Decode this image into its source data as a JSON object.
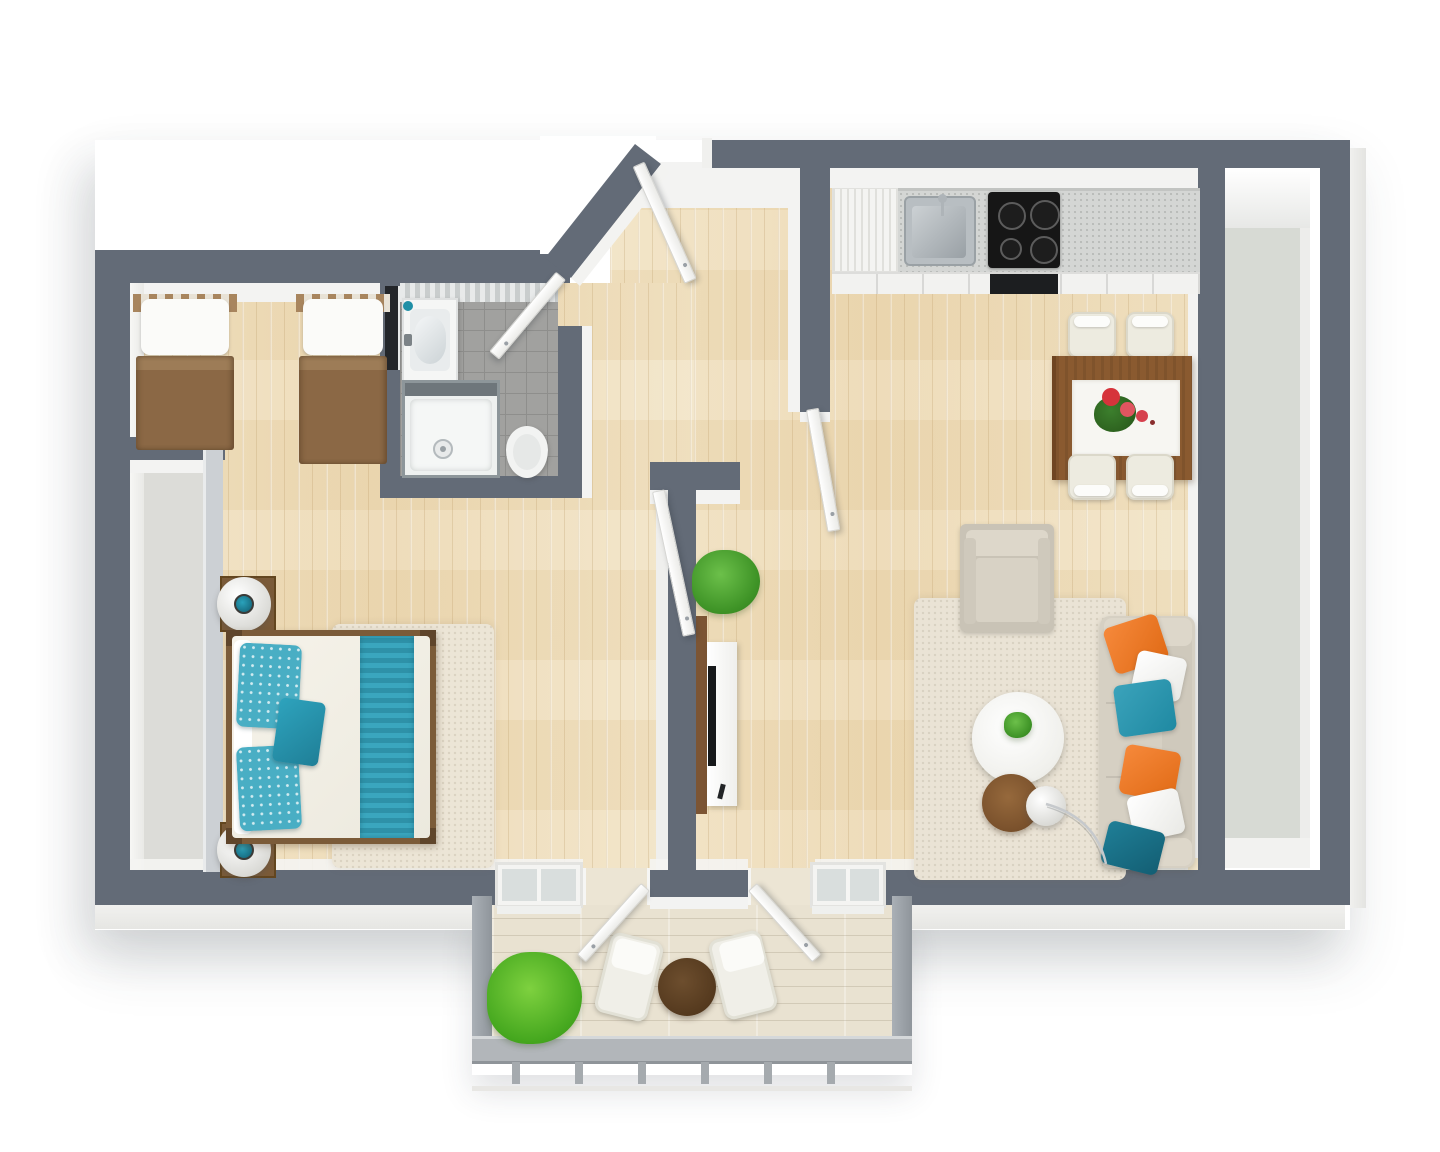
{
  "scene": {
    "title": "3D Floor Plan — One-Bedroom Apartment with Balcony",
    "view": "top-down 3D render",
    "background": "#ffffff"
  },
  "palette": {
    "wall": "#636b77",
    "wall_light": "#ccd0d4",
    "wall_face": "#f3f3f2",
    "wood_floor": "#eedcba",
    "balcony_floor": "#e9e2d1",
    "bathroom_tile": "#a1a19f",
    "closet_floor": "#dcdcd8",
    "side_balcony_floor": "#d7dad4",
    "rug": "#eae3d5",
    "sofa_beige": "#d6d0c3",
    "pillow_orange": "#ef7b28",
    "pillow_teal": "#2b93ac",
    "pillow_dark_teal": "#176d84",
    "bed_runner_teal": "#3aa6be",
    "blanket_brown": "#8b6845",
    "wood_furniture": "#8a5a30",
    "plant_green": "#46a81f",
    "railing_gray": "#b2b6ba"
  },
  "rooms": {
    "bedroom": {
      "name": "Bedroom"
    },
    "bathroom": {
      "name": "Bathroom"
    },
    "hallway": {
      "name": "Entry Hallway"
    },
    "living_room": {
      "name": "Living Room"
    },
    "kitchen": {
      "name": "Kitchen"
    },
    "dining_area": {
      "name": "Dining Area"
    },
    "closet": {
      "name": "Closet Nook"
    },
    "side_balcony": {
      "name": "Side Balcony"
    },
    "balcony": {
      "name": "Balcony"
    }
  },
  "furniture": {
    "twin_bed_1": "Twin bed with brown blanket",
    "twin_bed_2": "Twin bed with brown blanket",
    "double_bed": "Double bed with teal pillows and runner",
    "nightstand_1": "Nightstand with round lamp",
    "nightstand_2": "Nightstand with round lamp",
    "bedroom_rug": "Beige rug",
    "vanity": "Bathroom sink with mirror",
    "shower": "Glass shower enclosure",
    "toilet": "Toilet",
    "fridge": "Tall kitchen unit / fridge",
    "kitchen_sink": "Stainless kitchen sink",
    "cooktop": "Cooktop with 4 burners",
    "oven": "Oven",
    "dining_table": "Wooden dining table with white runner and flowers",
    "dining_chair": "White dining chair",
    "armchair": "Beige armchair",
    "living_rug": "Beige area rug",
    "coffee_table": "Round white coffee table with plant",
    "side_table": "Round wooden side table",
    "floor_lamp": "Chrome arc floor lamp",
    "sofa": "Beige sofa with throw pillows",
    "tv_console": "TV console with television and remote",
    "living_plant": "Potted green plant",
    "balcony_plant": "Potted green plant",
    "balcony_table": "Round bistro table",
    "balcony_chair": "Outdoor chair",
    "entry_door": "Entry door (open)",
    "bathroom_door": "Bathroom door (open)",
    "bedroom_door": "Bedroom door (open)",
    "living_door": "Living room door (open)",
    "balcony_door_left": "Balcony french door (open)",
    "balcony_door_right": "Balcony french door (open)",
    "balcony_window_left": "Balcony window",
    "balcony_window_right": "Balcony window",
    "railing": "Balcony railing"
  },
  "counts": {
    "sofa_pillows": 6,
    "dining_chairs": 4,
    "cooktop_burners": 4,
    "twin_beds": 2
  }
}
